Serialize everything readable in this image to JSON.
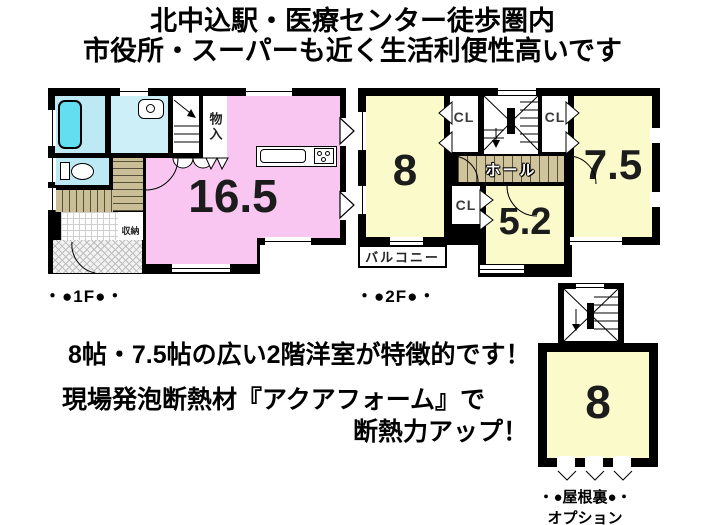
{
  "header": {
    "line1": "北中込駅・医療センター徒歩圏内",
    "line2": "市役所・スーパーも近く生活利便性高いです"
  },
  "floor1f": {
    "caption": "・●1F●・",
    "ldk_size": "16.5",
    "storage_top": "物入",
    "storage_hall": "収納"
  },
  "floor2f": {
    "caption": "・●2F●・",
    "room_west_size": "8",
    "room_east_size": "7.5",
    "room_south_size": "5.2",
    "closet_west": "CL",
    "closet_east": "CL",
    "closet_south": "CL",
    "hall": "ホール",
    "balcony": "バルコニー"
  },
  "attic": {
    "room_size": "8",
    "caption_line1": "・●屋根裏●・",
    "caption_line2": "オプション"
  },
  "notes": {
    "line1": "8帖・7.5帖の広い2階洋室が特徴的です！",
    "line2": "現場発泡断熱材『アクアフォーム』で",
    "line3": "断熱力アップ！"
  },
  "colors": {
    "wall": "#000000",
    "ldk_pink": "#f8c6f0",
    "room_yellow": "#fbfacb",
    "bath_cyan": "#bce9f3",
    "washroom_cyan": "#cdf0f8",
    "bathtub_cyan": "#63ddf0",
    "stair_tan": "#c9be95",
    "text": "#000000"
  }
}
